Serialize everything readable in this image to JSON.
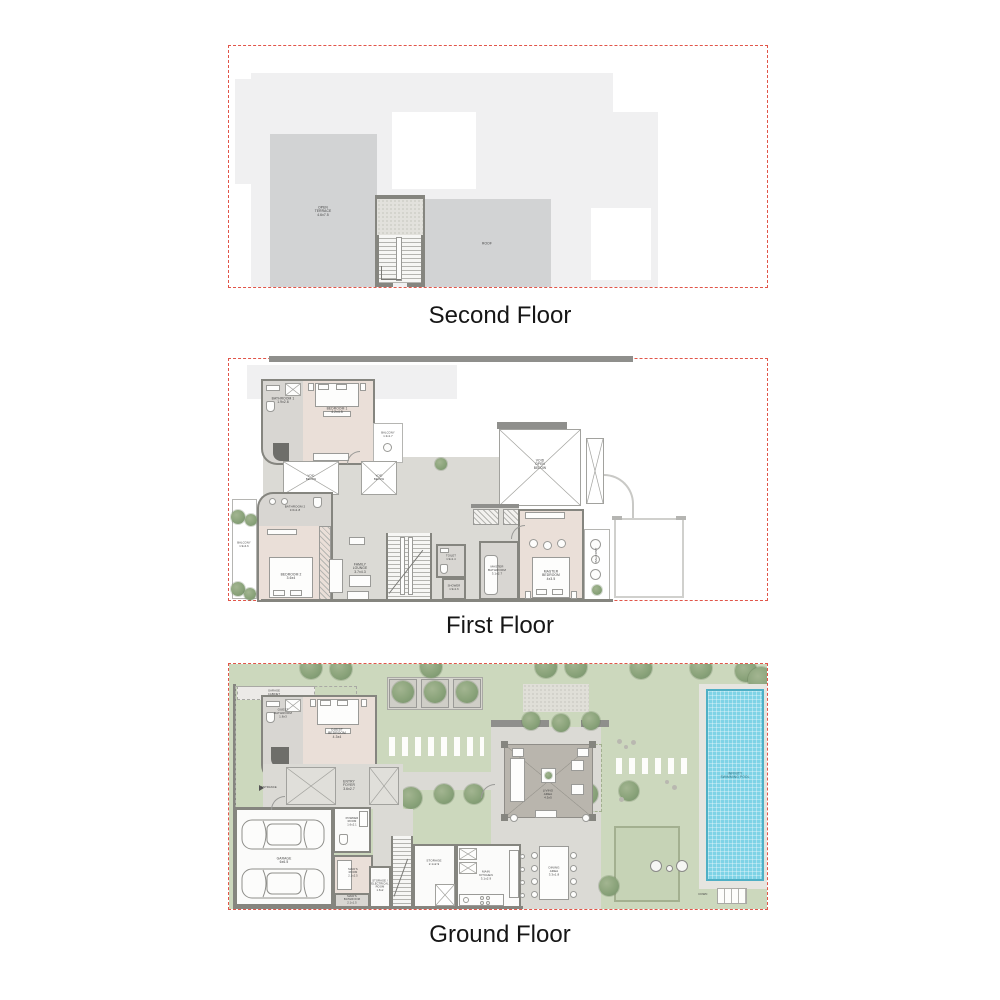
{
  "colors": {
    "boundary_red": "#e15549",
    "footprint_gray": "#f0f0f1",
    "terrace_gray": "#d2d3d4",
    "wall_gray": "#85857f",
    "bedroom_beige": "#eadfd8",
    "bathroom_gray": "#d8d6d2",
    "concrete": "#dbdad5",
    "garden_green": "#ccd8bd",
    "tree_green": "#8aa37a",
    "pool_blue": "#7ed3e6",
    "caption_black": "#161616"
  },
  "floors": {
    "second": {
      "caption": "Second Floor",
      "labels": {
        "terrace": "OPEN\nTERRACE\n4.6x7.5",
        "roof": "ROOF"
      }
    },
    "first": {
      "caption": "First Floor",
      "labels": {
        "bathroom1": "BATHROOM 1\n1.9x2.6",
        "bedroom1": "BEDROOM 1\n4.2x4.5",
        "balcony1": "BALCONY\n1.3x1.7",
        "void_a": "VOID\nBELOW",
        "void_b": "VOID\nBELOW",
        "void_main": "VOID\nOPEN\nBELOW",
        "balcony2": "BALCONY\n1.9x4.6",
        "bathroom2": "BATHROOM 2\n3.6x1.8",
        "bedroom2": "BEDROOM 2\n3.6x4",
        "family_lounge": "FAMILY\nLOUNGE\n3.7x4.3",
        "toilet": "TOILET\n1.9x1.4",
        "shower": "SHOWER\n1.9x1.6",
        "master_bathroom": "MASTER\nBATHROOM\n3.1x2.7",
        "master_bedroom": "MASTER\nBEDROOM\n4x3.5",
        "balcony3": "BALCONY"
      }
    },
    "ground": {
      "caption": "Ground Floor",
      "labels": {
        "garage_cabinet": "GARAGE\nCABINET",
        "guest_bathroom": "GUEST\nBATHROOM\n1.8x3",
        "guest_bedroom": "GUEST\nBEDROOM\n4.3x4",
        "entrance": "ENTRANCE",
        "entry_foyer": "ENTRY\nFOYER\n3.6x2.7",
        "garage": "GARAGE\n6x6.5",
        "powder_room": "POWDER\nROOM\n1.6x2.1",
        "maids_room": "MAID'S\nROOM\n2.1x2.5",
        "maids_bathroom": "MAID'S\nBATHROOM\n2.1x1.5",
        "storage_electrical": "STORAGE /\nELECTRICAL\nROOM\n1.6x2",
        "storage": "STORAGE\n2.1x2.9",
        "main_kitchen": "MAIN\nKITCHEN\n3.1x2.9",
        "dining_area": "DINING\nAREA\n3.3x1.8",
        "living_area": "LIVING\nAREA\n4.5x5",
        "pool": "INFINITY\nSWIMMING POOL",
        "down": "DOWN"
      }
    }
  }
}
